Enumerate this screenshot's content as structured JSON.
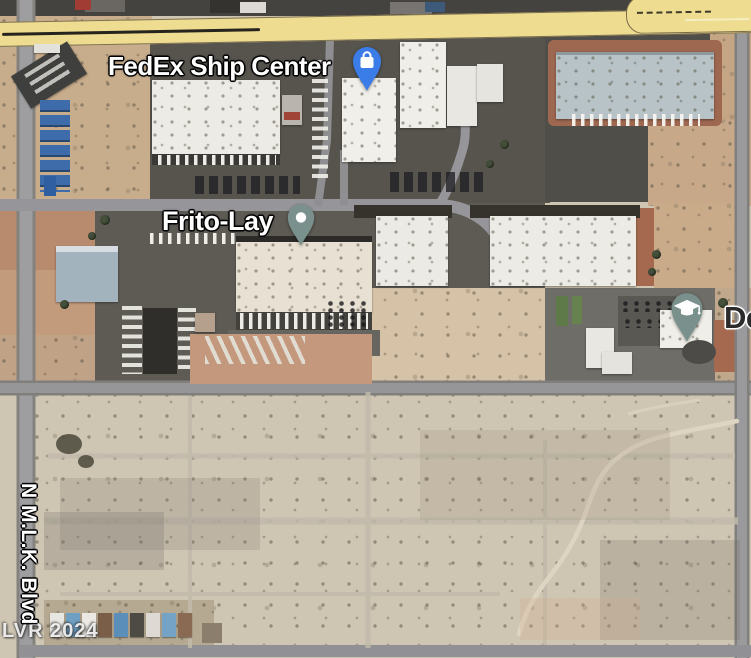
{
  "map_labels": {
    "fedex": "FedEx Ship Center",
    "frito_lay": "Frito-Lay",
    "school_partial": "De",
    "street_vertical": "N M.L.K. Blvd",
    "watermark": "LVR 2024"
  },
  "pins": {
    "fedex": {
      "icon": "shopping-bag-icon",
      "color": "#3b7de8"
    },
    "frito_lay": {
      "icon": "dot-icon",
      "color": "#7a908c"
    },
    "school": {
      "icon": "graduation-cap-icon",
      "color": "#7a908c"
    }
  },
  "colors": {
    "highway_yellow": "#eedc90",
    "place_label_text": "#ffffff",
    "place_label_halo": "#000000",
    "school_label_text": "#2b2b2b",
    "desert_ground": "#cfc5b3",
    "industrial_dirt": "#c8ad8c",
    "asphalt": "#57544e",
    "red_landscaping": "#a5694f"
  }
}
